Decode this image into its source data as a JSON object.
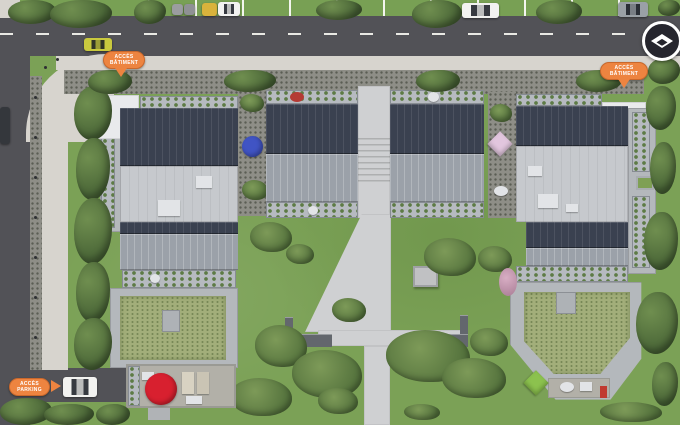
{
  "overlay": {
    "markers": [
      {
        "id": "access-batiment-nw",
        "line1": "ACCÈS",
        "line2": "BÂTIMENT",
        "arrow": "down"
      },
      {
        "id": "access-batiment-ne",
        "line1": "ACCÈS",
        "line2": "BÂTIMENT",
        "arrow": "down"
      },
      {
        "id": "access-parking-sw",
        "line1": "ACCÈS",
        "line2": "PARKING",
        "arrow": "right"
      }
    ],
    "compass": {
      "icon": "compass-north-icon"
    }
  },
  "scene": {
    "parasols": [
      "red",
      "blue",
      "pink",
      "green"
    ],
    "vehicles_visible": 8
  },
  "theme": {
    "colors": {
      "accent_orange": "#ed8440",
      "accent_orange_dark": "#c9682c",
      "marker_red": "#d8202f",
      "parasol_blue": "#4054c4",
      "parasol_pink": "#e2c6de",
      "parasol_green": "#8cc24e",
      "roof_dark": "#3a4150",
      "roof_green": "#a2ae7a",
      "grass": "#7ba156",
      "road": "#525257",
      "sidewalk": "#d7d4ce",
      "compass_bg": "#26262e",
      "car_yellow": "#c9c93e"
    }
  }
}
